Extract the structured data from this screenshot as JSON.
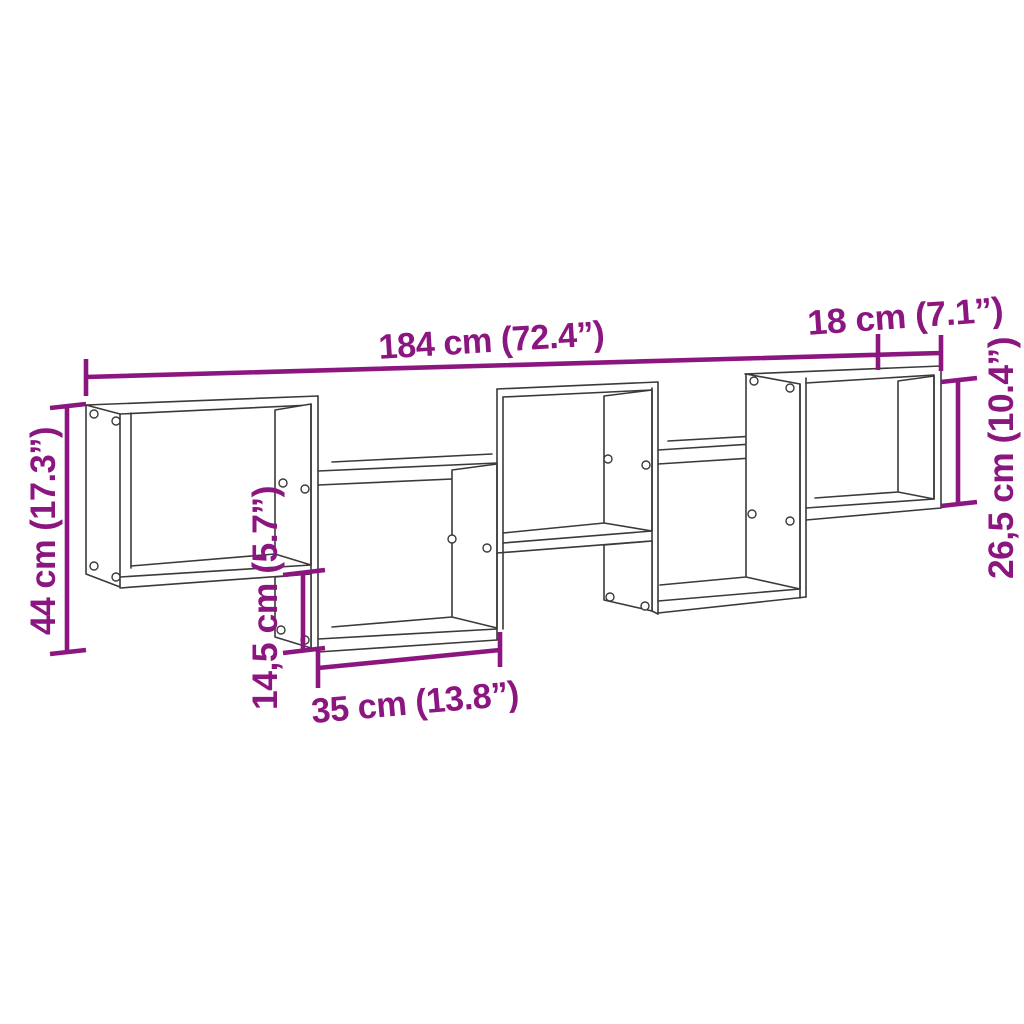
{
  "diagram": {
    "type": "product-dimension-diagram",
    "product": "staggered wall shelf with 5 cube compartments",
    "background_color": "#ffffff",
    "line_art_color": "#3a3a3a",
    "dimension_color": "#8c1680",
    "dimensions": {
      "total_width": {
        "label": "184 cm (72.4”)",
        "cm": 184,
        "inches": 72.4
      },
      "depth": {
        "label": "18 cm (7.1”)",
        "cm": 18,
        "inches": 7.1
      },
      "total_height": {
        "label": "44 cm (17.3”)",
        "cm": 44,
        "inches": 17.3
      },
      "stagger_height": {
        "label": "14,5 cm (5.7”)",
        "cm": 14.5,
        "inches": 5.7
      },
      "compartment_width": {
        "label": "35 cm (13.8”)",
        "cm": 35,
        "inches": 13.8
      },
      "compartment_height": {
        "label": "26,5 cm (10.4”)",
        "cm": 26.5,
        "inches": 10.4
      }
    }
  }
}
